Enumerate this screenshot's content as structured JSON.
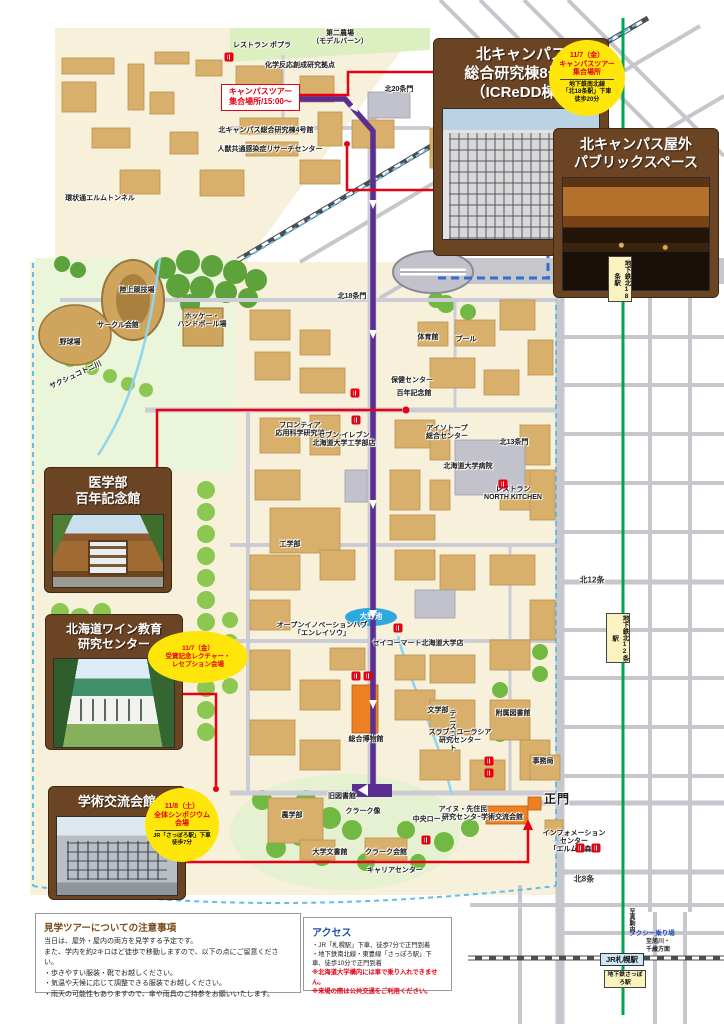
{
  "callouts": {
    "icredd": {
      "title": "北キャンパス\n総合研究棟8号館\n（ICReDD棟）"
    },
    "public_space": {
      "title": "北キャンパス屋外\nパブリックスペース"
    },
    "med_memorial": {
      "title": "医学部\n百年記念館"
    },
    "wine_center": {
      "title": "北海道ワイン教育\n研究センター"
    },
    "gakujutsu": {
      "title": "学術交流会館"
    }
  },
  "badges": {
    "tour_meeting": {
      "line1": "11/7（金）",
      "line2": "キャンパスツアー",
      "line3": "集合場所",
      "note": "地下鉄南北線\n「北18条駅」下車\n徒歩20分"
    },
    "reception": {
      "line1": "11/7（金）",
      "line2": "受賞記念レクチャー・",
      "line3": "レセプション会場"
    },
    "symposium": {
      "line1": "11/8（土）",
      "line2": "全体シンポジウム",
      "line3": "会場",
      "note": "JR「さっぽろ駅」下車\n徒歩7分"
    }
  },
  "tour_start": {
    "text": "キャンパスツアー\n集合場所/15:00～"
  },
  "notice": {
    "title": "見学ツアーについての注意事項",
    "lines": [
      "当日は、屋外・屋内の両方を見学する予定です。",
      "また、学内を約2キロほど徒歩で移動しますので、以下の点にご留意ください。",
      "・歩きやすい服装・靴でお越しください。",
      "・気温や天候に応じて調整できる服装でお越しください。",
      "・雨天の可能性もありますので、傘や雨具のご持参をお願いいたします。"
    ]
  },
  "access": {
    "title": "アクセス",
    "lines": [
      "・JR「札幌駅」下車、徒歩7分で正門到着",
      "・地下鉄南北線・東豊線「さっぽろ駅」下車、徒歩10分で正門到着"
    ],
    "warnings": [
      "※北海道大学構内には車で乗り入れできません。",
      "※来場の際は公共交通をご利用ください。"
    ]
  },
  "stations": {
    "kita18": "地下鉄北18条駅",
    "kita12": "地下鉄北12条駅",
    "jr_sapporo": "JR札幌駅",
    "subway_sapporo": "地下鉄さっぽろ駅",
    "taxi": "タクシー乗り場",
    "to_south": "至真駒内",
    "to_east": "至旭川・\n千歳方面"
  },
  "map_labels": [
    {
      "t": "レストラン ポプラ",
      "x": 262,
      "y": 46
    },
    {
      "t": "第二農場\n（モデルバーン）",
      "x": 340,
      "y": 38
    },
    {
      "t": "化学反応創成研究拠点",
      "x": 300,
      "y": 66
    },
    {
      "t": "北20条門",
      "x": 399,
      "y": 90
    },
    {
      "t": "北キャンパス総合研究棟4号館",
      "x": 266,
      "y": 131
    },
    {
      "t": "人獣共通感染症リサーチセンター",
      "x": 270,
      "y": 150
    },
    {
      "t": "環状通エルムトンネル",
      "x": 100,
      "y": 199
    },
    {
      "t": "北18条門",
      "x": 352,
      "y": 297
    },
    {
      "t": "陸上競技場",
      "x": 137,
      "y": 291
    },
    {
      "t": "野球場",
      "x": 70,
      "y": 343
    },
    {
      "t": "サークル会館",
      "x": 118,
      "y": 326
    },
    {
      "t": "ホッケー・\nハンドボール場",
      "x": 202,
      "y": 321
    },
    {
      "t": "サクシュコトニ川",
      "x": 76,
      "y": 376,
      "r": -25
    },
    {
      "t": "体育館",
      "x": 428,
      "y": 338
    },
    {
      "t": "プール",
      "x": 466,
      "y": 340
    },
    {
      "t": "保健センター",
      "x": 412,
      "y": 381
    },
    {
      "t": "百年記念館",
      "x": 414,
      "y": 394
    },
    {
      "t": "アイソトープ\n総合センター",
      "x": 447,
      "y": 433
    },
    {
      "t": "北13条門",
      "x": 514,
      "y": 443
    },
    {
      "t": "フロンティア\n応用科学研究棟",
      "x": 300,
      "y": 430
    },
    {
      "t": "セブン-イレブン\n北海道大学工学部店",
      "x": 344,
      "y": 440
    },
    {
      "t": "北海道大学病院",
      "x": 468,
      "y": 467
    },
    {
      "t": "レストラン\nNORTH KITCHEN",
      "x": 513,
      "y": 494
    },
    {
      "t": "工学部",
      "x": 290,
      "y": 545
    },
    {
      "t": "大野池",
      "x": 371,
      "y": 617,
      "c": "w"
    },
    {
      "t": "オープンイノベーションハブ\n「エンレイソウ」",
      "x": 322,
      "y": 630
    },
    {
      "t": "セイコーマート北海道大学店",
      "x": 418,
      "y": 644
    },
    {
      "t": "文学部",
      "x": 438,
      "y": 711
    },
    {
      "t": "附属図書館",
      "x": 513,
      "y": 714
    },
    {
      "t": "テニスコート",
      "x": 452,
      "y": 730,
      "c": "v"
    },
    {
      "t": "スラブ・ユーラシア\n研究センター",
      "x": 460,
      "y": 737
    },
    {
      "t": "総合博物館",
      "x": 366,
      "y": 740
    },
    {
      "t": "事務局",
      "x": 543,
      "y": 762
    },
    {
      "t": "旧図書館",
      "x": 342,
      "y": 797
    },
    {
      "t": "農学部",
      "x": 292,
      "y": 816
    },
    {
      "t": "クラーク像",
      "x": 363,
      "y": 812
    },
    {
      "t": "中央ローン",
      "x": 430,
      "y": 820
    },
    {
      "t": "アイヌ・先住民\n研究センター",
      "x": 463,
      "y": 814
    },
    {
      "t": "学術交流会館",
      "x": 502,
      "y": 818
    },
    {
      "t": "正門",
      "x": 557,
      "y": 800,
      "c": "g"
    },
    {
      "t": "インフォメーション\nセンター\n「エルムの森」",
      "x": 574,
      "y": 842
    },
    {
      "t": "大学文書館",
      "x": 330,
      "y": 853
    },
    {
      "t": "クラーク会館",
      "x": 386,
      "y": 853
    },
    {
      "t": "キャリアセンター",
      "x": 395,
      "y": 871
    },
    {
      "t": "北18条",
      "x": 586,
      "y": 286,
      "c": "s"
    },
    {
      "t": "北12条",
      "x": 592,
      "y": 580,
      "c": "s"
    },
    {
      "t": "北8条",
      "x": 584,
      "y": 879,
      "c": "s"
    }
  ],
  "map_icons": [
    {
      "x": 229,
      "y": 57
    },
    {
      "x": 355,
      "y": 393
    },
    {
      "x": 356,
      "y": 420
    },
    {
      "x": 503,
      "y": 484
    },
    {
      "x": 398,
      "y": 628
    },
    {
      "x": 356,
      "y": 676
    },
    {
      "x": 368,
      "y": 676
    },
    {
      "x": 489,
      "y": 761
    },
    {
      "x": 489,
      "y": 773
    },
    {
      "x": 426,
      "y": 840
    },
    {
      "x": 580,
      "y": 848
    },
    {
      "x": 596,
      "y": 848
    }
  ]
}
